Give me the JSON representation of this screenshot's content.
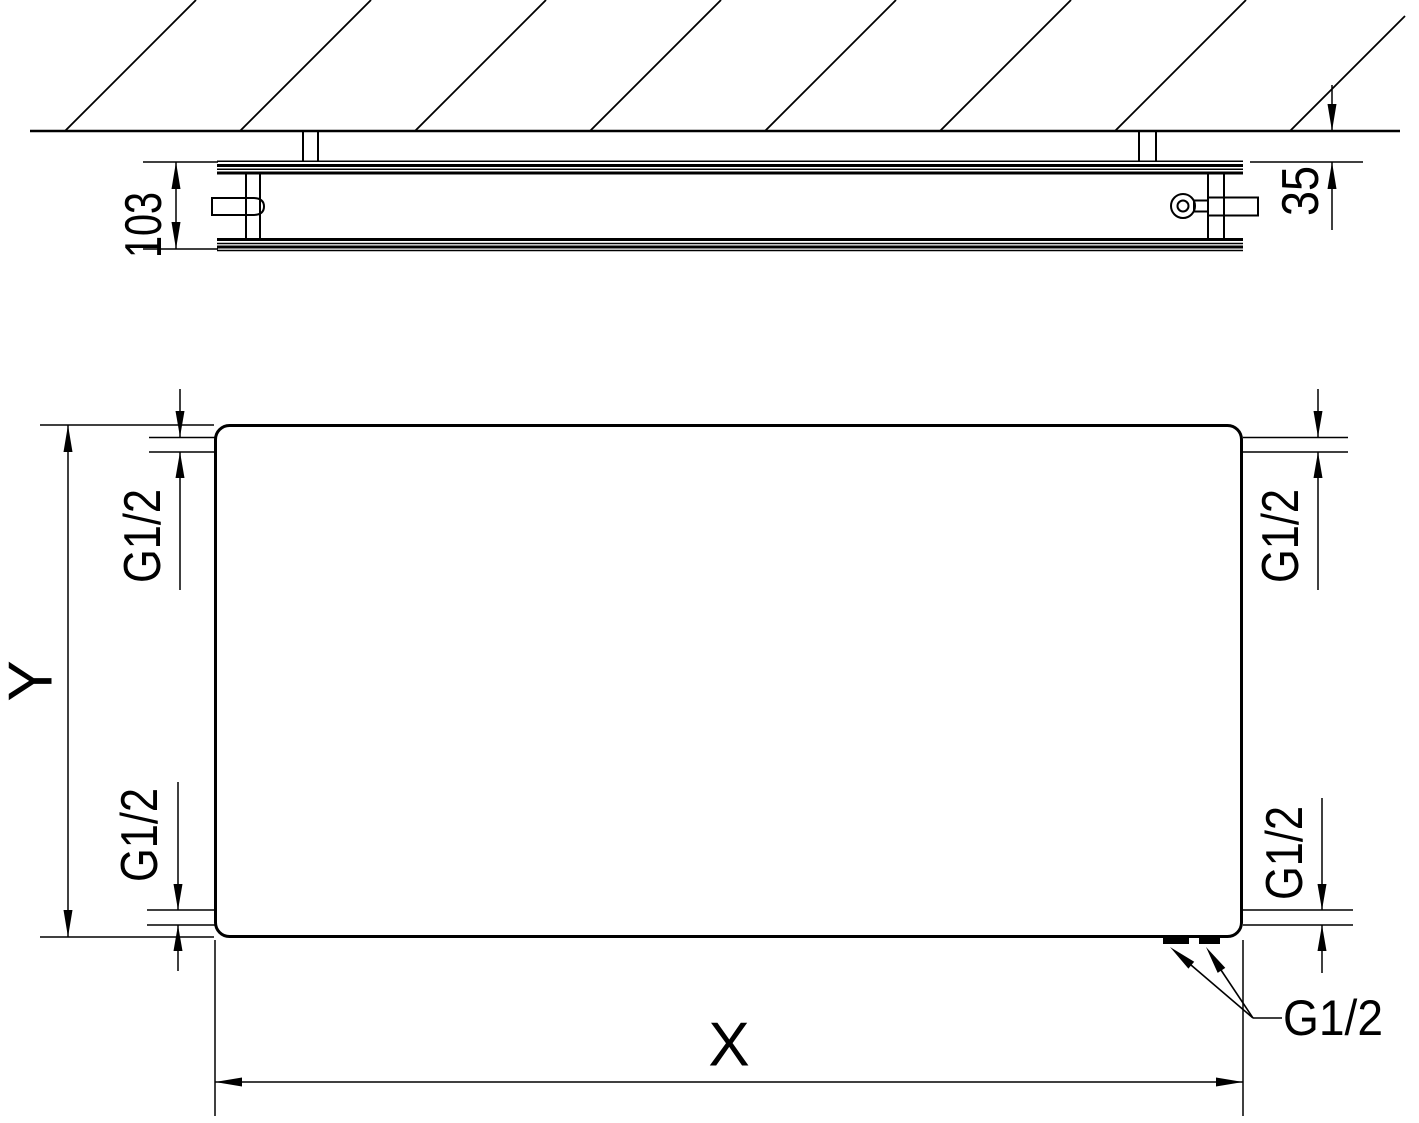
{
  "colors": {
    "line": "#000000",
    "background": "#ffffff"
  },
  "side_view": {
    "depth_label": "103",
    "wall_gap_label": "35"
  },
  "front_view": {
    "width_label": "X",
    "height_label": "Y",
    "connections": {
      "top_left": "G1/2",
      "top_right": "G1/2",
      "bottom_left": "G1/2",
      "bottom_right": "G1/2",
      "bottom_pair": "G1/2"
    }
  }
}
